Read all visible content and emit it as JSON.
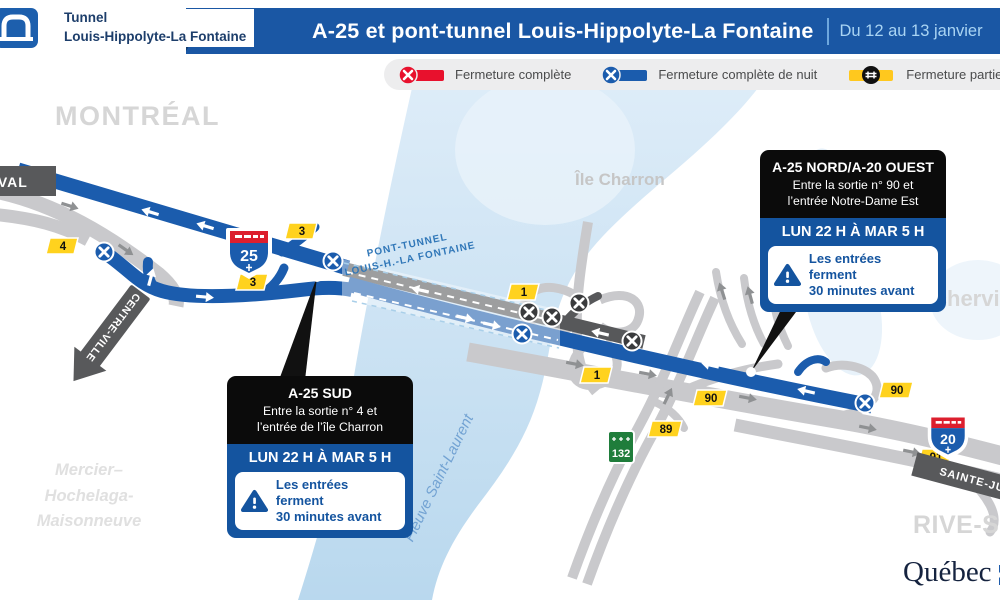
{
  "header": {
    "logo": {
      "line1": "Tunnel",
      "line2": "Louis-Hippolyte-La Fontaine"
    },
    "title": "A-25 et pont-tunnel Louis-Hippolyte-La Fontaine",
    "date_range": "Du 12 au 13 janvier"
  },
  "legend": {
    "items": [
      {
        "icon": "x-circle-red",
        "label": "Fermeture complète",
        "color": "#e8112d"
      },
      {
        "icon": "x-circle-blue",
        "label": "Fermeture complète de nuit",
        "color": "#1b5cad"
      },
      {
        "icon": "hash-circle-yellow",
        "label": "Fermeture partielle (# voie ouverte)",
        "color": "#ffc81e"
      }
    ]
  },
  "map": {
    "area_labels": {
      "montreal": "MONTRÉAL",
      "ile_charron": "Île Charron",
      "boucherville": "Boucherville",
      "rive_sud": "RIVE-SUD",
      "borough_line1": "Mercier–",
      "borough_line2": "Hochelaga-",
      "borough_line3": "Maisonneuve",
      "fleuve": "Fleuve Saint-Laurent",
      "pont_tunnel_line1": "PONT-TUNNEL",
      "pont_tunnel_line2": "LOUIS-H.-LA FONTAINE"
    },
    "signs": {
      "laval": "LAVAL",
      "centre_ville": "CENTRE-VILLE",
      "sainte_julie": "SAINTE-JULIE"
    },
    "shields": {
      "a25": "25",
      "a20": "20",
      "r132": "132"
    },
    "exit_markers": [
      {
        "label": "4"
      },
      {
        "label": "3"
      },
      {
        "label": "3"
      },
      {
        "label": "1"
      },
      {
        "label": "1"
      },
      {
        "label": "90"
      },
      {
        "label": "90"
      },
      {
        "label": "89"
      },
      {
        "label": "91"
      }
    ]
  },
  "callouts": {
    "sud": {
      "title": "A-25 SUD",
      "desc_line1": "Entre la sortie n° 4 et",
      "desc_line2": "l’entrée de l’île Charron",
      "time": "LUN 22 H À MAR 5 H",
      "warning_line1": "Les entrées ferment",
      "warning_line2": "30 minutes avant"
    },
    "nord": {
      "title": "A-25 NORD/A-20 OUEST",
      "desc_line1": "Entre la sortie n° 90 et",
      "desc_line2": "l’entrée Notre-Dame Est",
      "time": "LUN 22 H À MAR 5 H",
      "warning_line1": "Les entrées ferment",
      "warning_line2": "30 minutes avant"
    }
  },
  "footer": {
    "brand": "Québec"
  },
  "colors": {
    "header_blue": "#1a57a4",
    "highway_blue": "#1b5cad",
    "closed_dark": "#57585a",
    "water": "#cfe4f4",
    "legend_red": "#e8112d",
    "exit_yellow": "#ffd21e",
    "route132_green": "#1f7d3b"
  }
}
